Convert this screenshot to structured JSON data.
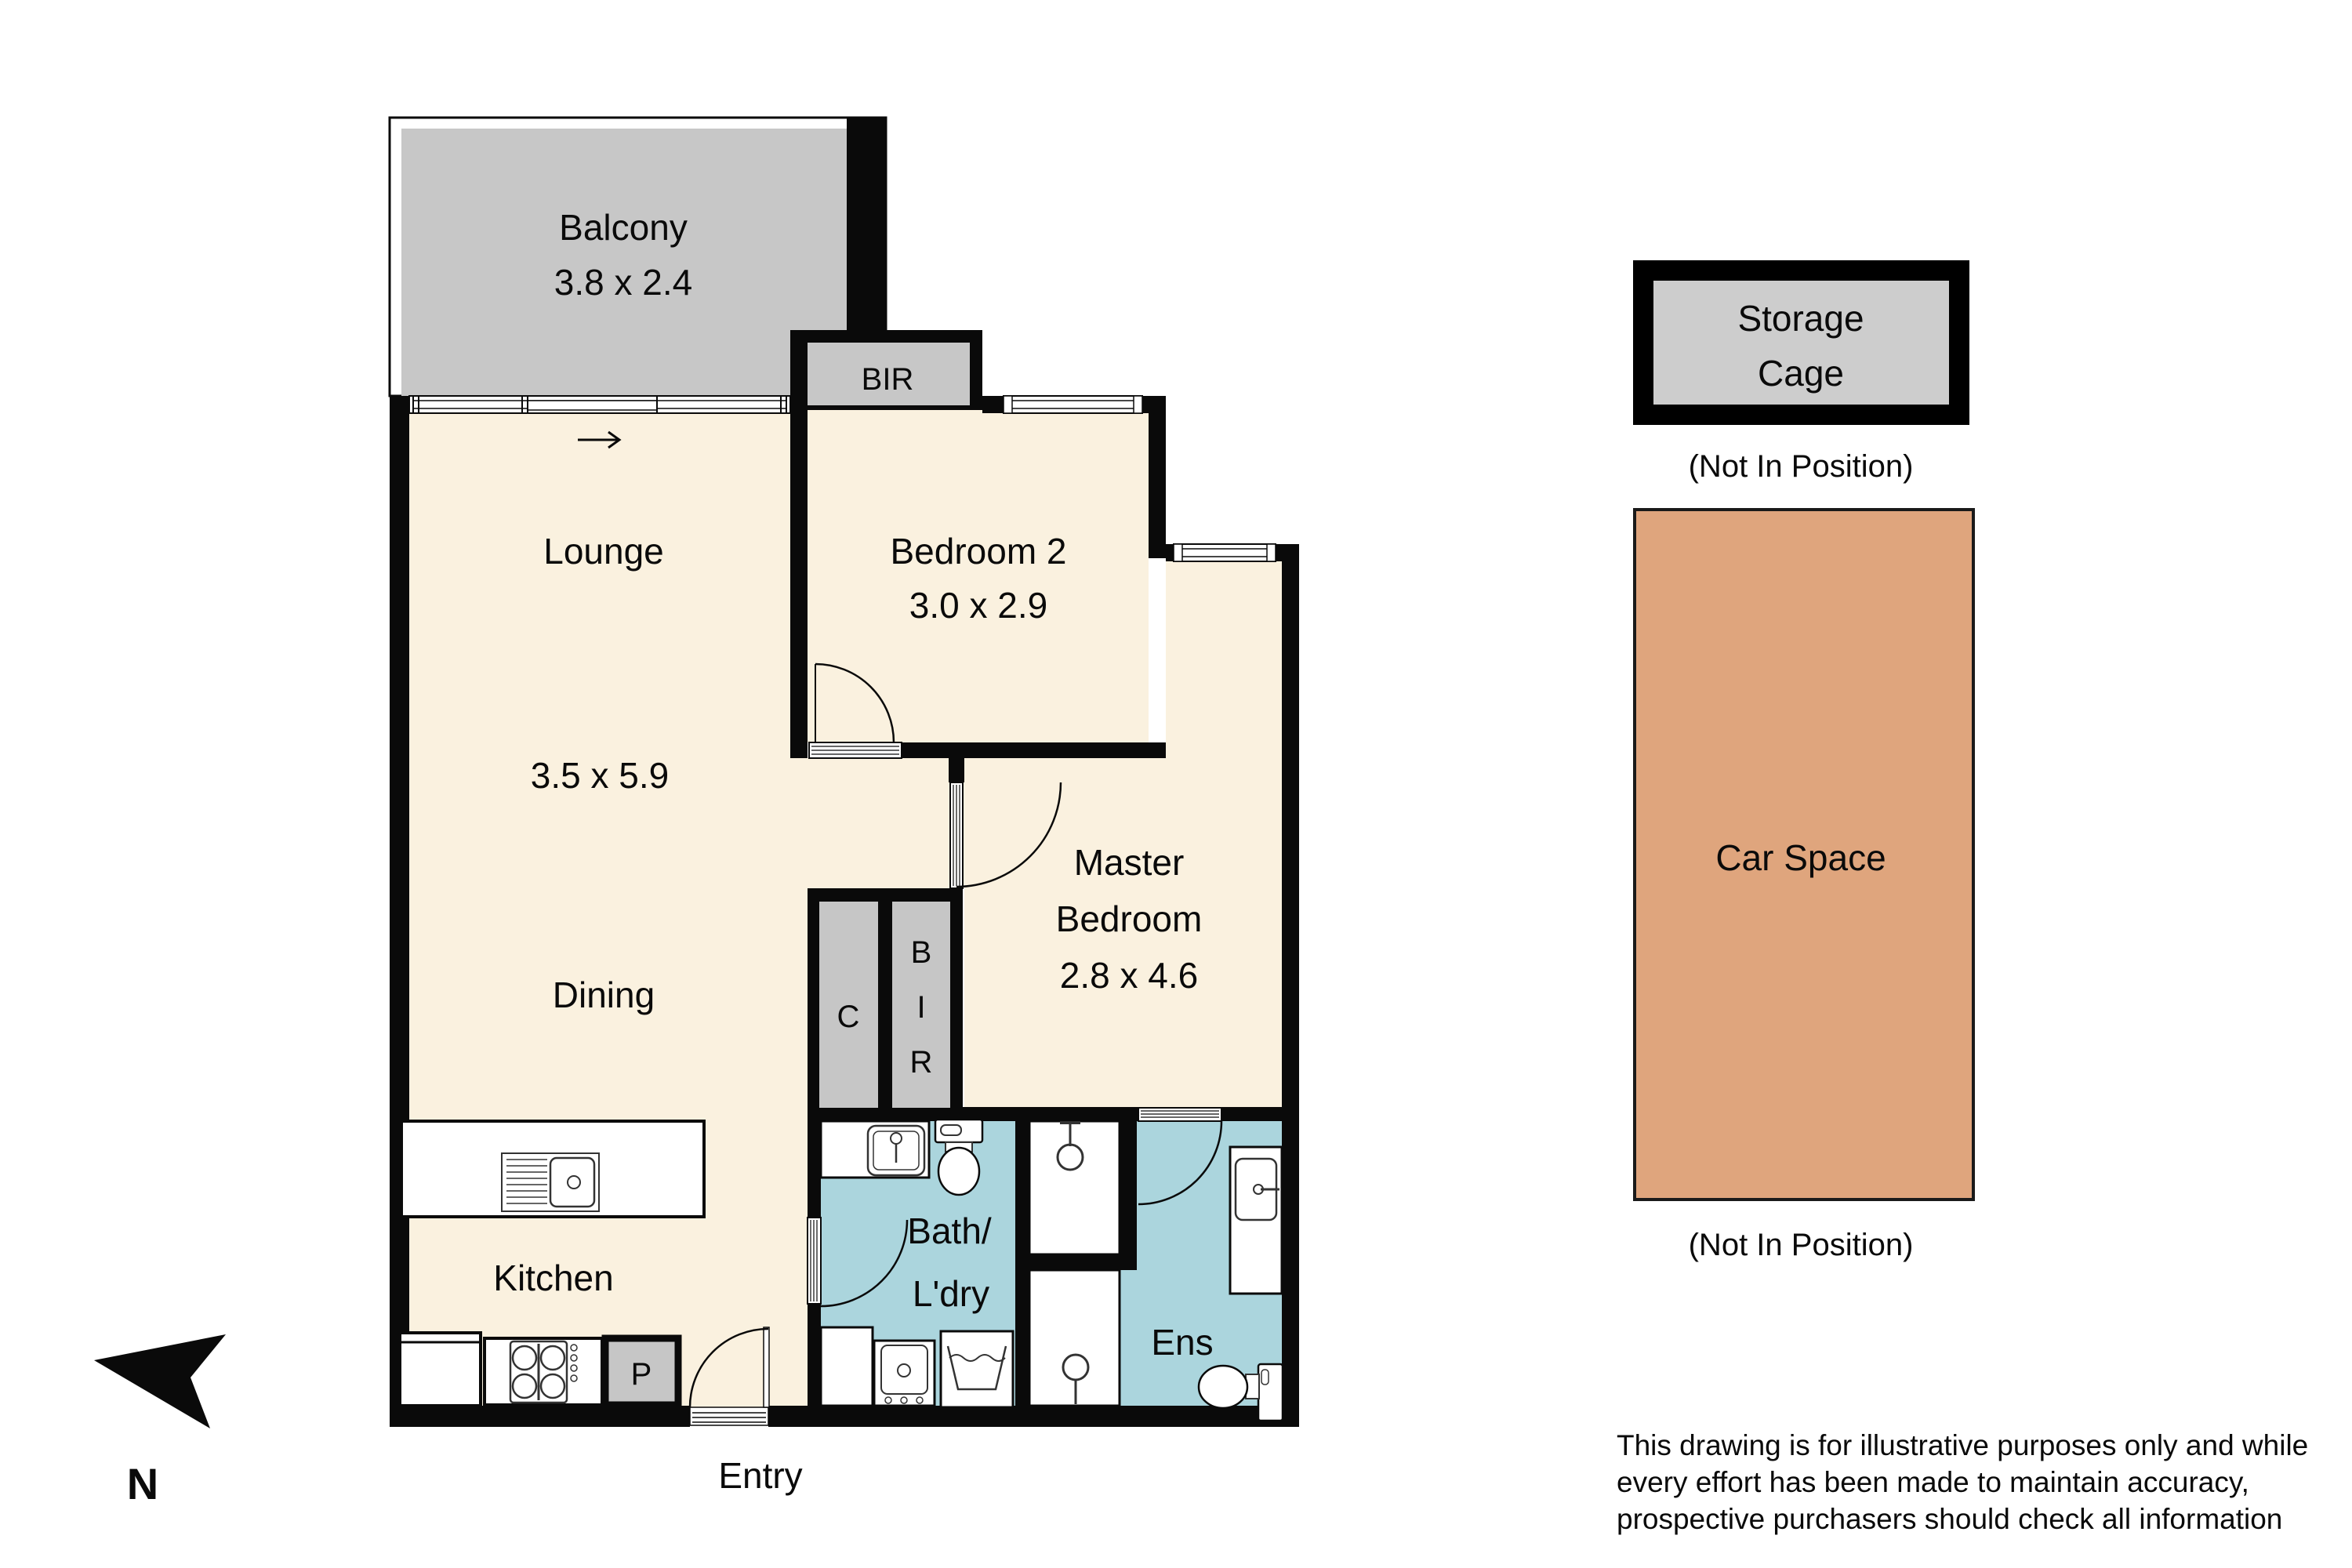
{
  "floorplan": {
    "rooms": {
      "balcony": {
        "name": "Balcony",
        "dims": "3.8 x 2.4"
      },
      "lounge": {
        "name": "Lounge",
        "dims": "3.5 x 5.9"
      },
      "dining": {
        "name": "Dining"
      },
      "kitchen": {
        "name": "Kitchen"
      },
      "bedroom2": {
        "name": "Bedroom 2",
        "dims": "3.0 x 2.9"
      },
      "master": {
        "line1": "Master",
        "line2": "Bedroom",
        "dims": "2.8 x 4.6"
      },
      "bath": {
        "line1": "Bath/",
        "line2": "L'dry"
      },
      "ensuite": {
        "name": "Ens"
      },
      "entry": {
        "name": "Entry"
      },
      "bir_top": "BIR",
      "bir_letters": [
        "B",
        "I",
        "R"
      ],
      "closet": "C",
      "pantry": "P"
    },
    "external": {
      "storage": {
        "line1": "Storage",
        "line2": "Cage",
        "note": "(Not In Position)"
      },
      "car_space": {
        "name": "Car Space",
        "note": "(Not In Position)"
      }
    },
    "compass": {
      "label": "N"
    },
    "disclaimer": {
      "line1": "This drawing is for illustrative purposes only and while",
      "line2": "every effort has been made to maintain accuracy,",
      "line3": "prospective purchasers should check all information"
    },
    "colors": {
      "wall": "#000000",
      "floor_cream": "#FAF1DF",
      "wet_area_teal": "#ABD5DD",
      "balcony_gray": "#C7C7C7",
      "storage_gray": "#CDCDCD",
      "car_space_tan": "#DFA57D"
    }
  }
}
